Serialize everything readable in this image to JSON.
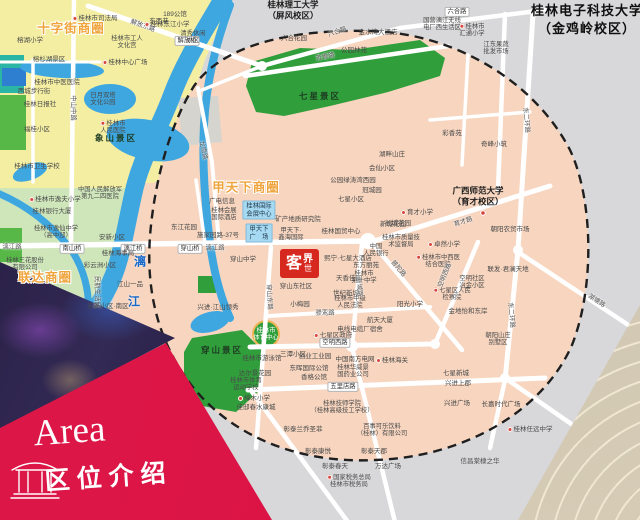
{
  "banner": {
    "title_en": "Area",
    "title_cn": "区位介绍"
  },
  "logo": {
    "char_1": "客",
    "char_2": "世",
    "char_3": "界"
  },
  "colors": {
    "banner_red": "#dd1747",
    "logo_red": "#d7281f",
    "map_pink": "#f7d5bf",
    "map_yellow": "#f4eea2",
    "west_green": "#cfe6bb",
    "park_green": "#2f9e3b",
    "water_blue": "#3fa7e0",
    "outside_gray": "#d8d8da",
    "big_label_orange": "#f0a43c",
    "water_text_blue": "#1668c9"
  },
  "map": {
    "base_zones": [
      {
        "pts": "0,0 230,0 205,60 185,120 160,180 140,190 0,190",
        "fill": "#f4eea2"
      },
      {
        "pts": "0,188 140,188 132,230 118,265 95,300 60,340 0,385",
        "fill": "#cfe6bb"
      },
      {
        "pts": "138,183 172,183 168,260 195,340 165,352 110,312 125,255 134,215",
        "fill": "#f7d5bf"
      },
      {
        "pts": "0,55 24,55 24,93 0,93",
        "fill": "#2ab5a5"
      },
      {
        "pts": "0,95 26,95 26,150 0,150",
        "fill": "#57b847"
      },
      {
        "pts": "0,228 22,228 22,262 0,262",
        "fill": "#57b847"
      },
      {
        "pts": "2,68 26,68 26,86 2,86",
        "fill": "#2e7fd0"
      }
    ],
    "boundary": {
      "d": "M 370,31 C 455,33 535,82 570,150 C 592,196 596,284 572,345 C 542,413 462,457 376,460 C 298,464 232,436 192,386 C 158,342 146,292 150,236 C 154,186 168,128 194,86 C 222,46 288,29 370,31 Z",
      "fill": "#f7d5bf",
      "stroke": "#1f1f1f"
    },
    "over_zones": [
      {
        "pts": "178,98 218,96 222,142 182,146",
        "fill": "#d6d4cf"
      }
    ],
    "park_fill": "#2f9e3b",
    "parks": [
      {
        "pts": "252,62 300,48 352,50 420,40 445,58 440,76 388,92 330,106 284,116 256,112 246,86"
      },
      {
        "pts": "192,338 242,330 262,350 258,392 236,412 202,406 184,378 184,352"
      },
      {
        "pts": "198,276 216,276 216,293 198,293"
      }
    ],
    "sport_circle": [
      266,
      334,
      13
    ],
    "water": {
      "color": "#3fa7e0",
      "paths": [
        {
          "d": "M 225,-5 C 205,30 185,60 172,95 C 158,132 140,160 133,195 C 127,222 124,240 120,255 C 113,285 97,310 78,332 C 62,350 48,370 40,392",
          "w": 18
        },
        {
          "d": "M 230,5 C 215,45 206,85 204,125 C 202,165 205,200 209,235 C 212,262 218,292 230,318",
          "w": 8
        },
        {
          "d": "M -5,192 C 28,205 52,226 70,248 C 84,268 90,292 88,314",
          "w": 7
        }
      ],
      "ellipses": [
        [
          148,
          140,
          42,
          20,
          12
        ],
        [
          62,
          69,
          42,
          9,
          3
        ],
        [
          110,
          99,
          26,
          15,
          0
        ],
        [
          30,
          172,
          18,
          8,
          -20
        ],
        [
          210,
          322,
          20,
          10,
          -15
        ]
      ]
    },
    "roads": [
      [
        88,
        6,
        262,
        66,
        5
      ],
      [
        262,
        66,
        400,
        28,
        4.5
      ],
      [
        400,
        28,
        545,
        10,
        4.5
      ],
      [
        74,
        0,
        71,
        245,
        4.5
      ],
      [
        33,
        60,
        33,
        182,
        3.5
      ],
      [
        0,
        62,
        100,
        62,
        3
      ],
      [
        0,
        246,
        368,
        241,
        5.5
      ],
      [
        198,
        88,
        212,
        162,
        4
      ],
      [
        212,
        162,
        219,
        243,
        4
      ],
      [
        262,
        66,
        202,
        90,
        3.5
      ],
      [
        245,
        76,
        448,
        46,
        4.5
      ],
      [
        271,
        247,
        256,
        448,
        4.5
      ],
      [
        368,
        243,
        550,
        186,
        5
      ],
      [
        362,
        243,
        352,
        346,
        4.5
      ],
      [
        372,
        243,
        462,
        350,
        4.5
      ],
      [
        250,
        347,
        435,
        344,
        5
      ],
      [
        435,
        344,
        478,
        242,
        4.5
      ],
      [
        268,
        316,
        430,
        307,
        4
      ],
      [
        248,
        390,
        545,
        378,
        5
      ],
      [
        352,
        347,
        395,
        522,
        4.5
      ],
      [
        505,
        14,
        498,
        190,
        4.5
      ],
      [
        468,
        55,
        462,
        165,
        3.5
      ],
      [
        430,
        120,
        530,
        112,
        3.5
      ],
      [
        533,
        14,
        518,
        250,
        5
      ],
      [
        518,
        250,
        505,
        380,
        5
      ],
      [
        505,
        380,
        490,
        448,
        4.5
      ],
      [
        518,
        252,
        642,
        334,
        4.5
      ],
      [
        505,
        378,
        580,
        430,
        4.5
      ],
      [
        252,
        392,
        348,
        522,
        4.5
      ],
      [
        196,
        180,
        205,
        243,
        3.5
      ]
    ],
    "junctions": [
      [
        368,
        241,
        8
      ],
      [
        352,
        346,
        6
      ],
      [
        435,
        344,
        5
      ],
      [
        505,
        378,
        5
      ],
      [
        262,
        66,
        5
      ],
      [
        518,
        250,
        5
      ]
    ],
    "labels": [
      {
        "x": 71,
        "y": 27,
        "t": "十字街商圈",
        "c": "big"
      },
      {
        "x": 246,
        "y": 186,
        "t": "甲天下商圈",
        "c": "big"
      },
      {
        "x": 45,
        "y": 276,
        "t": "联达商圈",
        "c": "big"
      },
      {
        "x": 140,
        "y": 261,
        "t": "漓",
        "c": "wtr"
      },
      {
        "x": 134,
        "y": 301,
        "t": "江",
        "c": "wtr"
      },
      {
        "x": 320,
        "y": 96,
        "t": "七星景区",
        "c": "park"
      },
      {
        "x": 222,
        "y": 350,
        "t": "穿山景区",
        "c": "park"
      },
      {
        "x": 116,
        "y": 138,
        "t": "象山景区",
        "c": "park"
      },
      {
        "x": 49,
        "y": 58,
        "t": "榕杉湖景区",
        "c": "s"
      },
      {
        "x": 293,
        "y": 10,
        "t": "桂林理工大学|（屏风校区）",
        "c": "uni"
      },
      {
        "x": 478,
        "y": 196,
        "t": "广西师范大学|（育才校区）",
        "c": "uni"
      },
      {
        "x": 483,
        "y": 213,
        "t": "",
        "c": "dotonly"
      },
      {
        "x": 587,
        "y": 20,
        "t": "桂林电子科技大学|（金鸡岭校区）",
        "c": "unilg"
      },
      {
        "x": 103,
        "y": 99,
        "t": "日月双塔|文化公园",
        "c": "s2"
      },
      {
        "x": 95,
        "y": 17,
        "t": "桂林市司法局",
        "c": "s",
        "i": true
      },
      {
        "x": 159,
        "y": 20,
        "t": "东西巷",
        "c": "s"
      },
      {
        "x": 127,
        "y": 42,
        "t": "桂林市工人|文化宫",
        "c": "s2"
      },
      {
        "x": 125,
        "y": 61,
        "t": "桂林中心广场",
        "c": "s",
        "i": true
      },
      {
        "x": 30,
        "y": 39,
        "t": "榕湖小学",
        "c": "s"
      },
      {
        "x": 57,
        "y": 81,
        "t": "桂林市中医医院",
        "c": "s"
      },
      {
        "x": 34,
        "y": 90,
        "t": "西城步行街",
        "c": "s"
      },
      {
        "x": 40,
        "y": 103,
        "t": "桂林日报社",
        "c": "s"
      },
      {
        "x": 113,
        "y": 127,
        "t": "桂林市|人民医院",
        "c": "s2",
        "i": true
      },
      {
        "x": 37,
        "y": 128,
        "t": "福桂小区",
        "c": "s"
      },
      {
        "x": 37,
        "y": 165,
        "t": "桂林市卫生学校",
        "c": "s"
      },
      {
        "x": 143,
        "y": 25,
        "t": "解放东路",
        "c": "rl",
        "r": 20
      },
      {
        "x": 74,
        "y": 108,
        "t": "中山中路",
        "c": "rl",
        "r": 90
      },
      {
        "x": 12,
        "y": 246,
        "t": "漓江路",
        "c": "rl"
      },
      {
        "x": 215,
        "y": 247,
        "t": "漓江路",
        "c": "rl"
      },
      {
        "x": 187,
        "y": 41,
        "t": "解放桥",
        "c": "chip"
      },
      {
        "x": 133,
        "y": 249,
        "t": "漓江桥",
        "c": "chip"
      },
      {
        "x": 72,
        "y": 249,
        "t": "南山桥",
        "c": "chip"
      },
      {
        "x": 190,
        "y": 249,
        "t": "穿山桥",
        "c": "chip"
      },
      {
        "x": 55,
        "y": 198,
        "t": "桂林市逸夫小学",
        "c": "s",
        "i": true
      },
      {
        "x": 52,
        "y": 210,
        "t": "桂林银行大厦",
        "c": "s"
      },
      {
        "x": 56,
        "y": 232,
        "t": "桂林市逸仙中学|（高中部）",
        "c": "s2"
      },
      {
        "x": 25,
        "y": 264,
        "t": "桂林三花股份|有限公司",
        "c": "s2"
      },
      {
        "x": 100,
        "y": 193,
        "t": "中国人民解放军|第九二四医院",
        "c": "s2"
      },
      {
        "x": 112,
        "y": 236,
        "t": "安新小区",
        "c": "s"
      },
      {
        "x": 118,
        "y": 252,
        "t": "桂林海事局",
        "c": "s"
      },
      {
        "x": 100,
        "y": 264,
        "t": "彩云洲小区",
        "c": "s"
      },
      {
        "x": 130,
        "y": 283,
        "t": "江山一品",
        "c": "s"
      },
      {
        "x": 98,
        "y": 292,
        "t": "民航生活区",
        "c": "rl",
        "r": 90
      },
      {
        "x": 108,
        "y": 305,
        "t": "安新小区·南区",
        "c": "s"
      },
      {
        "x": 193,
        "y": 37,
        "t": "清秀休闲|小区",
        "c": "s2"
      },
      {
        "x": 167,
        "y": 23,
        "t": "桂林东江小学",
        "c": "s",
        "i": true
      },
      {
        "x": 175,
        "y": 13,
        "t": "189公馆",
        "c": "s"
      },
      {
        "x": 337,
        "y": 31,
        "t": "六合路",
        "c": "rl",
        "r": -18
      },
      {
        "x": 457,
        "y": 12,
        "t": "六合路",
        "c": "chip"
      },
      {
        "x": 294,
        "y": 37,
        "t": "六合花园",
        "c": "s"
      },
      {
        "x": 354,
        "y": 49,
        "t": "公园林苑",
        "c": "s"
      },
      {
        "x": 325,
        "y": 56,
        "t": "芳香路",
        "c": "rl",
        "r": -12
      },
      {
        "x": 378,
        "y": 31,
        "t": "金水湾大酒店",
        "c": "s"
      },
      {
        "x": 442,
        "y": 24,
        "t": "国营漓江无线|电厂西生活区",
        "c": "s2"
      },
      {
        "x": 472,
        "y": 30,
        "t": "桂林市|汇通小学",
        "c": "s2",
        "i": true
      },
      {
        "x": 496,
        "y": 48,
        "t": "江东果蔬|批发市场",
        "c": "s2"
      },
      {
        "x": 452,
        "y": 132,
        "t": "彩香苑",
        "c": "s"
      },
      {
        "x": 527,
        "y": 120,
        "t": "东二环路",
        "c": "rl",
        "r": 85
      },
      {
        "x": 512,
        "y": 315,
        "t": "东二环路",
        "c": "rl",
        "r": 85
      },
      {
        "x": 494,
        "y": 143,
        "t": "奇峰小筑",
        "c": "s"
      },
      {
        "x": 392,
        "y": 153,
        "t": "湖畔山庄",
        "c": "s"
      },
      {
        "x": 382,
        "y": 167,
        "t": "会仙小区",
        "c": "s"
      },
      {
        "x": 353,
        "y": 179,
        "t": "公园绿涛湾西园",
        "c": "s"
      },
      {
        "x": 372,
        "y": 189,
        "t": "冠城园",
        "c": "s"
      },
      {
        "x": 351,
        "y": 198,
        "t": "七星小区",
        "c": "s"
      },
      {
        "x": 417,
        "y": 211,
        "t": "育才小学",
        "c": "s",
        "i": true
      },
      {
        "x": 398,
        "y": 222,
        "t": "长城花园",
        "c": "s"
      },
      {
        "x": 463,
        "y": 221,
        "t": "育才路",
        "c": "rl",
        "r": -18
      },
      {
        "x": 597,
        "y": 300,
        "t": "湖塘路",
        "c": "rl",
        "r": 33
      },
      {
        "x": 222,
        "y": 200,
        "t": "广电信息",
        "c": "s"
      },
      {
        "x": 224,
        "y": 214,
        "t": "桂林会展|国际酒店",
        "c": "s2"
      },
      {
        "x": 259,
        "y": 210,
        "t": "桂林国际|会展中心",
        "c": "blue"
      },
      {
        "x": 259,
        "y": 233,
        "t": "甲天下|广　场",
        "c": "blue"
      },
      {
        "x": 218,
        "y": 234,
        "t": "施家园路-37号",
        "c": "s"
      },
      {
        "x": 184,
        "y": 226,
        "t": "东江花园",
        "c": "s"
      },
      {
        "x": 243,
        "y": 258,
        "t": "穿山中学",
        "c": "s"
      },
      {
        "x": 218,
        "y": 306,
        "t": "兴进·江山领秀",
        "c": "s"
      },
      {
        "x": 204,
        "y": 150,
        "t": "龙隐路",
        "c": "rl",
        "r": 78
      },
      {
        "x": 298,
        "y": 218,
        "t": "矿产地质研究院",
        "c": "s"
      },
      {
        "x": 291,
        "y": 234,
        "t": "甲天下·|鑫海国际",
        "c": "s2"
      },
      {
        "x": 341,
        "y": 230,
        "t": "桂林国贸中心",
        "c": "s"
      },
      {
        "x": 348,
        "y": 257,
        "t": "熙宁·七星大酒店",
        "c": "s"
      },
      {
        "x": 349,
        "y": 277,
        "t": "天香佳园",
        "c": "s"
      },
      {
        "x": 296,
        "y": 285,
        "t": "穿山东社区",
        "c": "s"
      },
      {
        "x": 300,
        "y": 303,
        "t": "小梅园",
        "c": "s"
      },
      {
        "x": 346,
        "y": 292,
        "t": "世纪新城",
        "c": "s"
      },
      {
        "x": 350,
        "y": 302,
        "t": "桂林市中级|人民法院",
        "c": "s2"
      },
      {
        "x": 270,
        "y": 297,
        "t": "穿山东路",
        "c": "rl",
        "r": 87
      },
      {
        "x": 376,
        "y": 250,
        "t": "中国|人民银行",
        "c": "s2"
      },
      {
        "x": 366,
        "y": 264,
        "t": "东方丽苑",
        "c": "s"
      },
      {
        "x": 364,
        "y": 277,
        "t": "桂林市|第一中学",
        "c": "s2"
      },
      {
        "x": 393,
        "y": 223,
        "t": "新城花园",
        "c": "s"
      },
      {
        "x": 401,
        "y": 241,
        "t": "桂林市质量技|术监督局",
        "c": "s2"
      },
      {
        "x": 444,
        "y": 243,
        "t": "卓然小学",
        "c": "s",
        "i": true
      },
      {
        "x": 438,
        "y": 261,
        "t": "桂林市中西医|结合医院",
        "c": "s2",
        "i": true
      },
      {
        "x": 410,
        "y": 303,
        "t": "阳光小学",
        "c": "s"
      },
      {
        "x": 452,
        "y": 294,
        "t": "七星区人民|检察院",
        "c": "s2",
        "i": true
      },
      {
        "x": 468,
        "y": 310,
        "t": "金地怡和东岸",
        "c": "s"
      },
      {
        "x": 472,
        "y": 282,
        "t": "空明社区|冶金小区",
        "c": "s2"
      },
      {
        "x": 510,
        "y": 228,
        "t": "朝阳农贸市场",
        "c": "s"
      },
      {
        "x": 508,
        "y": 268,
        "t": "联发·君澜天地",
        "c": "s"
      },
      {
        "x": 360,
        "y": 287,
        "t": "新城路",
        "c": "rl",
        "r": 85
      },
      {
        "x": 399,
        "y": 268,
        "t": "普陀路",
        "c": "rl",
        "r": 50
      },
      {
        "x": 444,
        "y": 275,
        "t": "空明西路",
        "c": "rl",
        "r": -68
      },
      {
        "x": 325,
        "y": 312,
        "t": "骖鸾路",
        "c": "rl"
      },
      {
        "x": 380,
        "y": 319,
        "t": "航天大厦",
        "c": "s"
      },
      {
        "x": 360,
        "y": 328,
        "t": "电线电缆厂宿舍",
        "c": "s"
      },
      {
        "x": 333,
        "y": 334,
        "t": "七星区政府",
        "c": "s",
        "i": true
      },
      {
        "x": 335,
        "y": 343,
        "t": "空明西路",
        "c": "chip"
      },
      {
        "x": 266,
        "y": 334,
        "t": "桂林市|体育中心",
        "c": "s2w"
      },
      {
        "x": 262,
        "y": 357,
        "t": "桂林市游泳馆",
        "c": "s"
      },
      {
        "x": 255,
        "y": 372,
        "t": "达尔景花园",
        "c": "s"
      },
      {
        "x": 246,
        "y": 384,
        "t": "桂林市体育|运动学校",
        "c": "s2"
      },
      {
        "x": 254,
        "y": 397,
        "t": "樟木小学",
        "c": "s",
        "i": true
      },
      {
        "x": 256,
        "y": 406,
        "t": "佳邸春水康城",
        "c": "s"
      },
      {
        "x": 293,
        "y": 353,
        "t": "三潭小区",
        "c": "s"
      },
      {
        "x": 315,
        "y": 355,
        "t": "创业工业园",
        "c": "s"
      },
      {
        "x": 309,
        "y": 367,
        "t": "东晖国际公馆",
        "c": "s"
      },
      {
        "x": 314,
        "y": 376,
        "t": "香格公馆",
        "c": "s"
      },
      {
        "x": 355,
        "y": 358,
        "t": "中国南方电网",
        "c": "s"
      },
      {
        "x": 392,
        "y": 359,
        "t": "桂林海关",
        "c": "s",
        "i": true
      },
      {
        "x": 353,
        "y": 371,
        "t": "桂林华威景|国药业公司",
        "c": "s2"
      },
      {
        "x": 343,
        "y": 387,
        "t": "五里店路",
        "c": "chip"
      },
      {
        "x": 342,
        "y": 407,
        "t": "桂林技师学院|（桂林高级技工学校）",
        "c": "s2"
      },
      {
        "x": 382,
        "y": 430,
        "t": "百事可乐饮料|（桂林）有限公司",
        "c": "s2"
      },
      {
        "x": 303,
        "y": 428,
        "t": "彰泰兰乔圣菲",
        "c": "s"
      },
      {
        "x": 318,
        "y": 450,
        "t": "彰泰康悦",
        "c": "s"
      },
      {
        "x": 335,
        "y": 465,
        "t": "彰泰春天",
        "c": "s"
      },
      {
        "x": 374,
        "y": 450,
        "t": "彰泰天郡",
        "c": "s"
      },
      {
        "x": 388,
        "y": 465,
        "t": "万达广场",
        "c": "s"
      },
      {
        "x": 349,
        "y": 481,
        "t": "国家税务总局|桂林市税务局",
        "c": "s2",
        "i": true
      },
      {
        "x": 456,
        "y": 372,
        "t": "七星新城",
        "c": "s"
      },
      {
        "x": 458,
        "y": 382,
        "t": "兴进上郡",
        "c": "s"
      },
      {
        "x": 457,
        "y": 402,
        "t": "兴进广场",
        "c": "s"
      },
      {
        "x": 501,
        "y": 403,
        "t": "长嘉时代广场",
        "c": "s"
      },
      {
        "x": 530,
        "y": 428,
        "t": "桂林任远中学",
        "c": "s",
        "i": true
      },
      {
        "x": 480,
        "y": 460,
        "t": "信昌棠棣之华",
        "c": "s"
      },
      {
        "x": 498,
        "y": 339,
        "t": "朝阳山庄|别墅区",
        "c": "s2"
      }
    ]
  }
}
